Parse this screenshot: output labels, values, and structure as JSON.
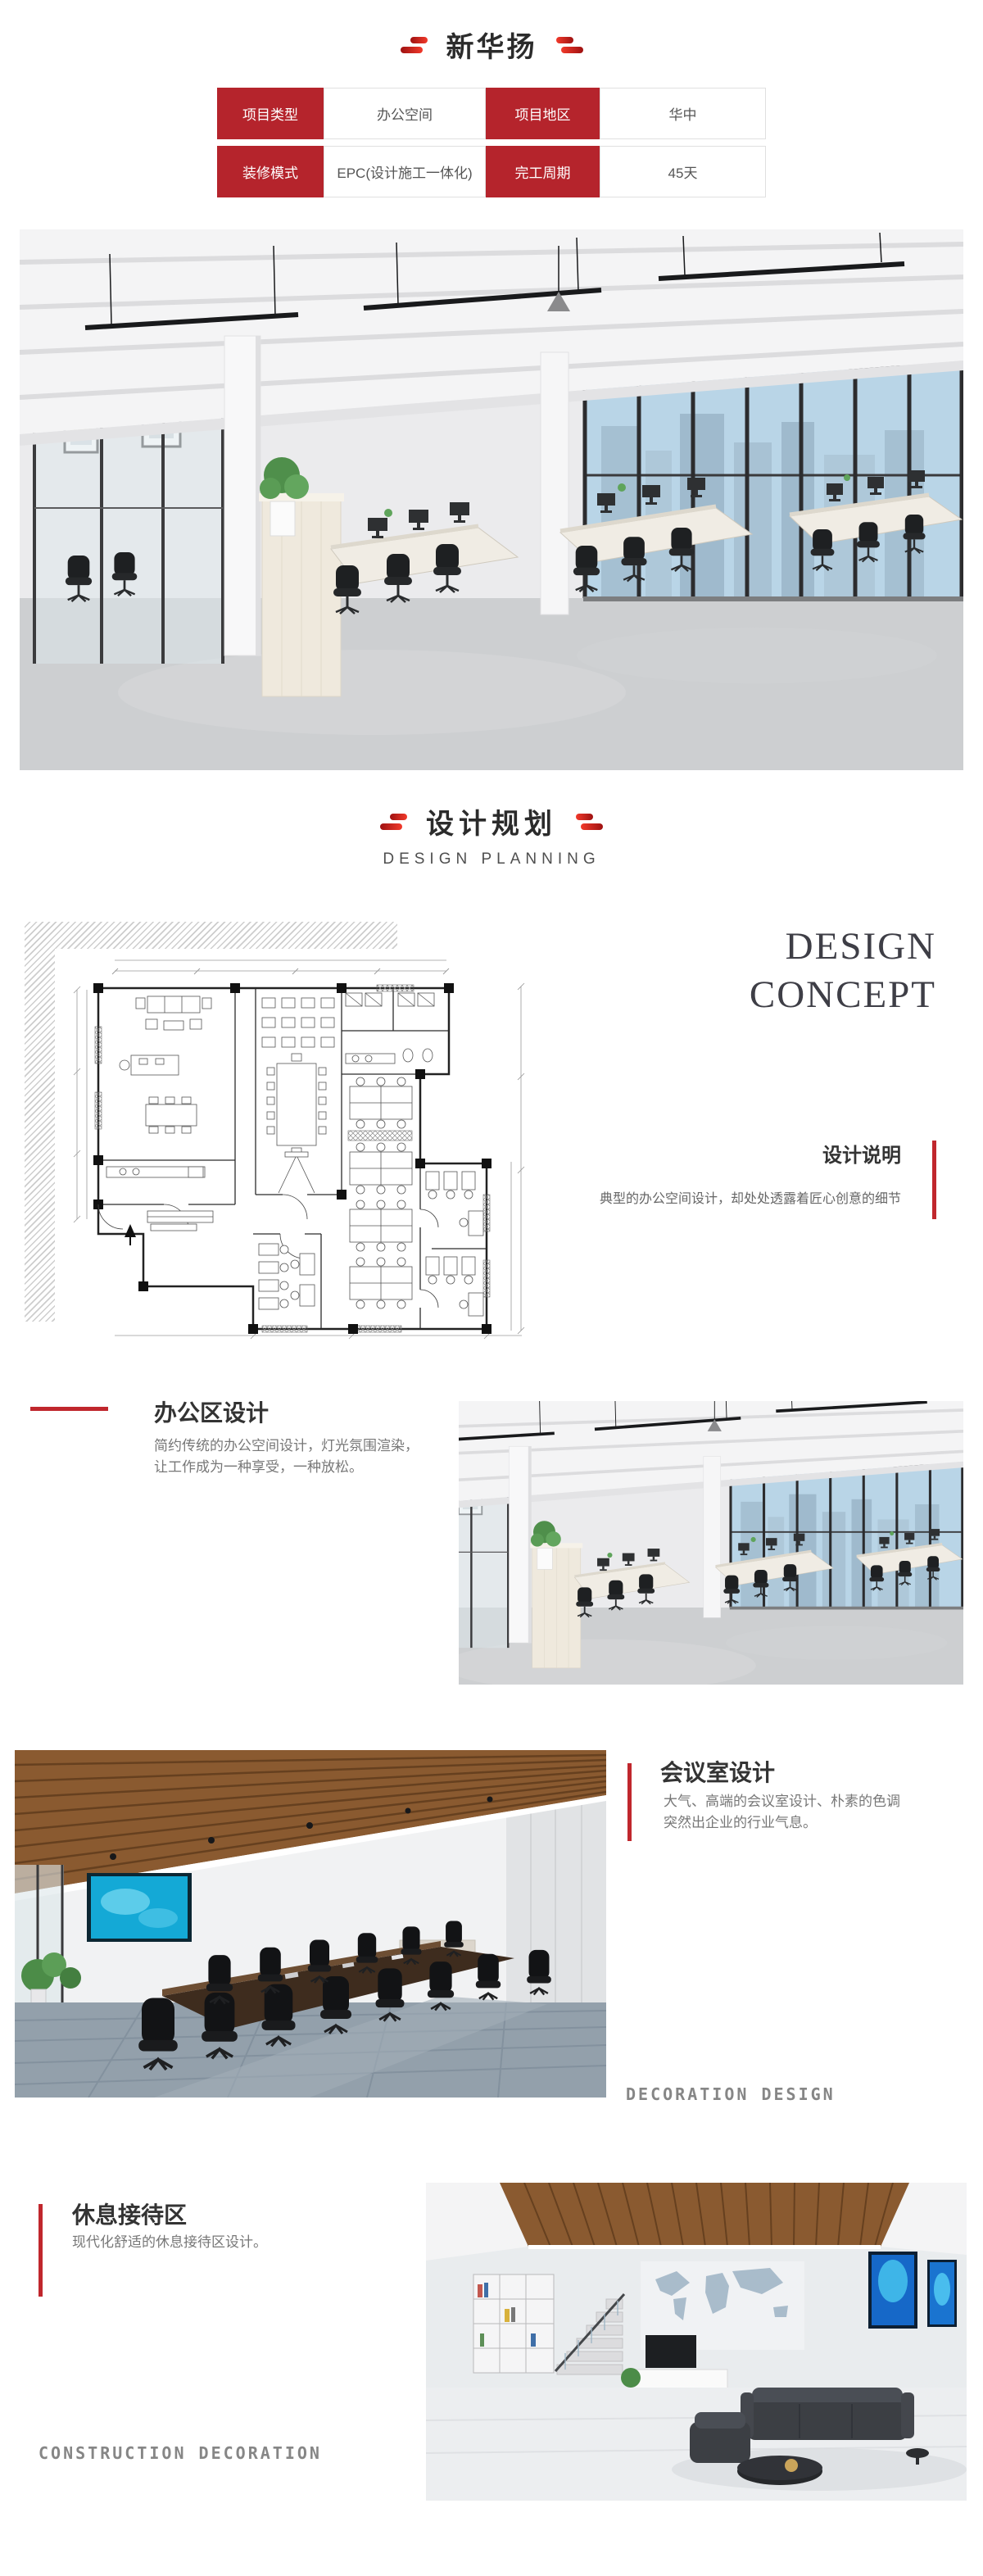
{
  "header": {
    "title": "新华扬"
  },
  "info_table": {
    "cells": [
      {
        "label": "项目类型",
        "value": "办公空间"
      },
      {
        "label": "项目地区",
        "value": "华中"
      },
      {
        "label": "装修模式",
        "value": "EPC(设计施工一体化)"
      },
      {
        "label": "完工周期",
        "value": "45天"
      }
    ]
  },
  "planning_section": {
    "title_cn": "设计规划",
    "title_en": "DESIGN PLANNING"
  },
  "design_concept": {
    "en_line1": "DESIGN",
    "en_line2": "CONCEPT",
    "note_heading": "设计说明",
    "note_text": "典型的办公空间设计，却处处透露着匠心创意的细节"
  },
  "office_area": {
    "heading": "办公区设计",
    "desc_line1": "简约传统的办公空间设计，灯光氛围渲染，",
    "desc_line2": "让工作成为一种享受，一种放松。"
  },
  "meeting_room": {
    "heading": "会议室设计",
    "desc_line1": "大气、高端的会议室设计、朴素的色调",
    "desc_line2": "突然出企业的行业气息。",
    "caption_en": "DECORATION DESIGN"
  },
  "reception": {
    "heading": "休息接待区",
    "desc": "现代化舒适的休息接待区设计。",
    "caption_en": "CONSTRUCTION DECORATION"
  },
  "colors": {
    "accent_red": "#b5242c",
    "mark_red_bright": "#f23a2b",
    "heading_dark": "#333333",
    "body_gray": "#777777",
    "caption_gray": "#868686"
  }
}
